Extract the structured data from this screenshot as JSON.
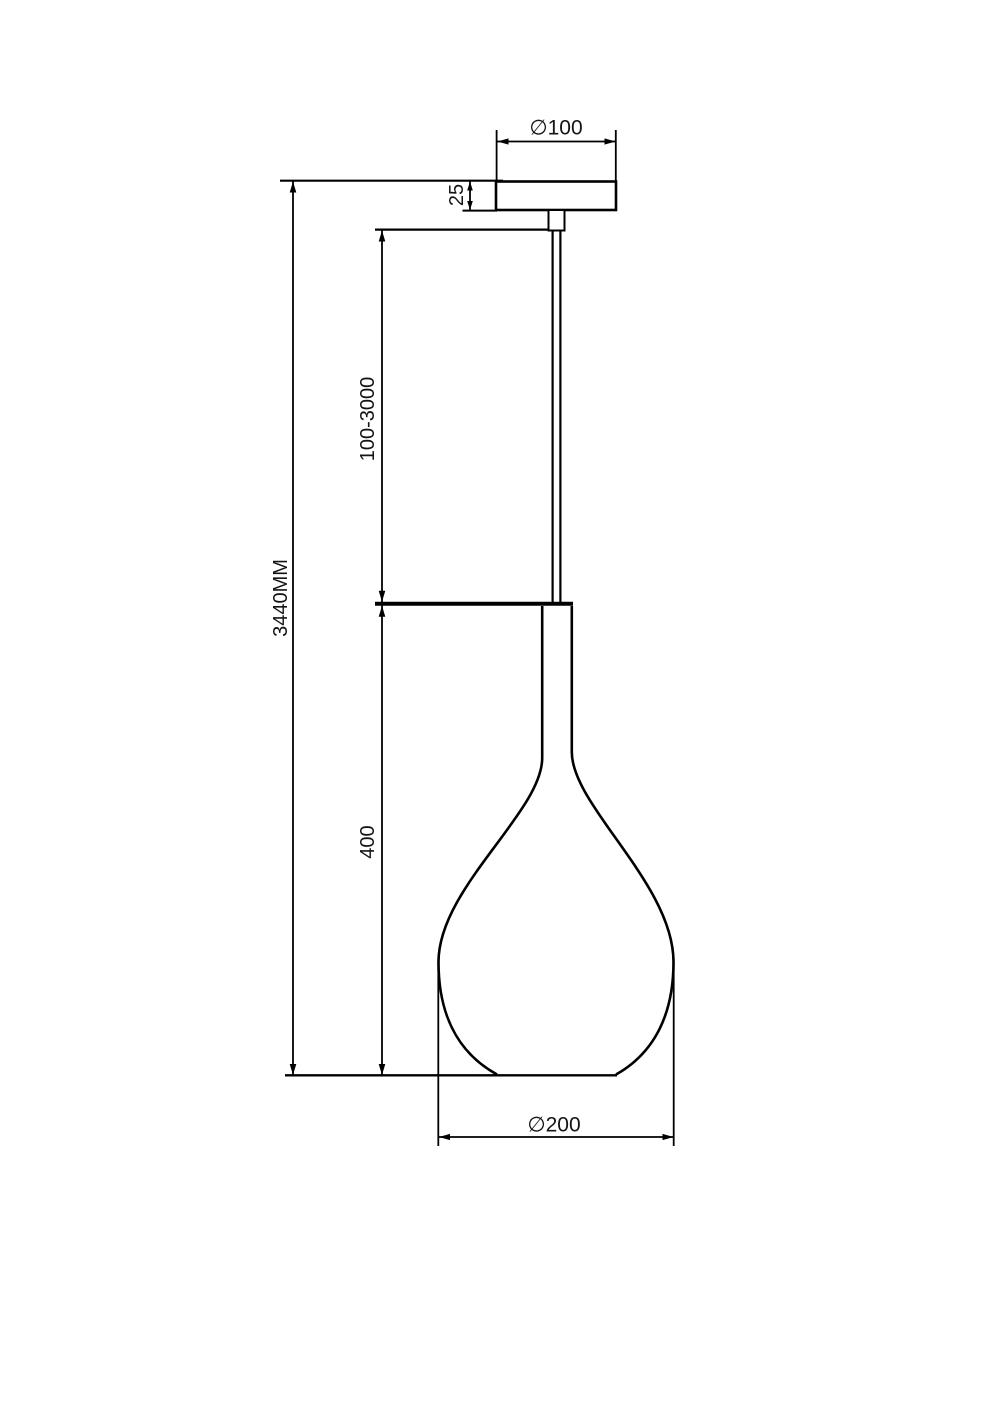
{
  "drawing": {
    "background_color": "#ffffff",
    "line_color": "#000000",
    "dimensions": {
      "canopy_diameter": "∅100",
      "canopy_height": "25",
      "cord_length_range": "100-3000",
      "overall_height": "3440MM",
      "shade_height": "400",
      "shade_diameter": "∅200"
    }
  }
}
